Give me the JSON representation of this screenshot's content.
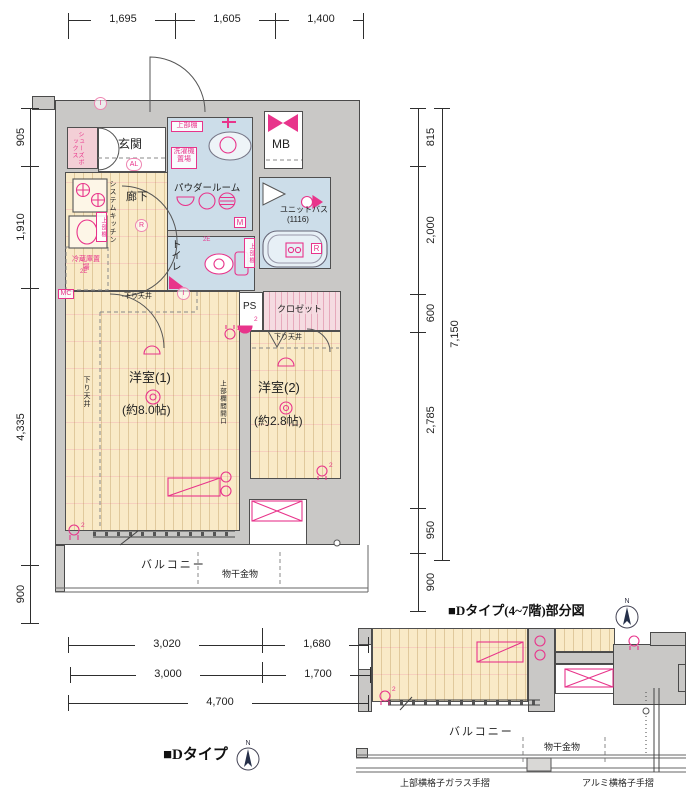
{
  "plan": {
    "rooms": {
      "genkan": "玄関",
      "shoes_box": "シューズボックス",
      "powder_room": "パウダールーム",
      "unit_bath": "ユニットバス",
      "unit_bath_size": "(1116)",
      "toilet": "トイレ",
      "hallway": "廊下",
      "system_kitchen": "システムキッチン",
      "room1": "洋室(1)",
      "room1_size": "(約8.0帖)",
      "room2": "洋室(2)",
      "room2_size": "(約2.8帖)",
      "closet": "クロゼット",
      "ps": "PS",
      "mb": "MB",
      "balcony": "バルコニー"
    },
    "labels": {
      "upper_shelf": "上部棚",
      "washer_place": "洗濯機置場",
      "fridge_place": "冷蔵庫置場",
      "lowered_ceiling": "下り天井",
      "transom_opening": "上部欄間開口",
      "drying_hardware": "物干金物"
    },
    "markers": {
      "i": "I",
      "al": "AL",
      "r": "R",
      "m": "M",
      "mc": "MC",
      "e2": "2E",
      "outlet2": "2"
    }
  },
  "dimensions": {
    "top": [
      "1,695",
      "1,605",
      "1,400"
    ],
    "left": [
      "905",
      "1,910",
      "4,335",
      "900"
    ],
    "right": [
      "815",
      "2,000",
      "600",
      "2,785",
      "950",
      "900"
    ],
    "right_total": "7,150",
    "bottom_upper": [
      "3,020",
      "1,680"
    ],
    "bottom_lower": [
      "3,000",
      "1,700"
    ],
    "bottom_total": "4,700"
  },
  "footer": {
    "type_label": "■Dタイプ",
    "north": "N"
  },
  "subplan": {
    "title": "■Dタイプ(4~7階)部分図",
    "railing_left": "上部横格子ガラス手摺",
    "railing_right": "アルミ横格子手摺"
  },
  "colors": {
    "accent_pink": "#e8348b",
    "wall_gray": "#c9c8c6",
    "floor_beige": "#f9eac7",
    "wet_blue": "#ccdde9",
    "closet_pink": "#f5dbe1"
  }
}
